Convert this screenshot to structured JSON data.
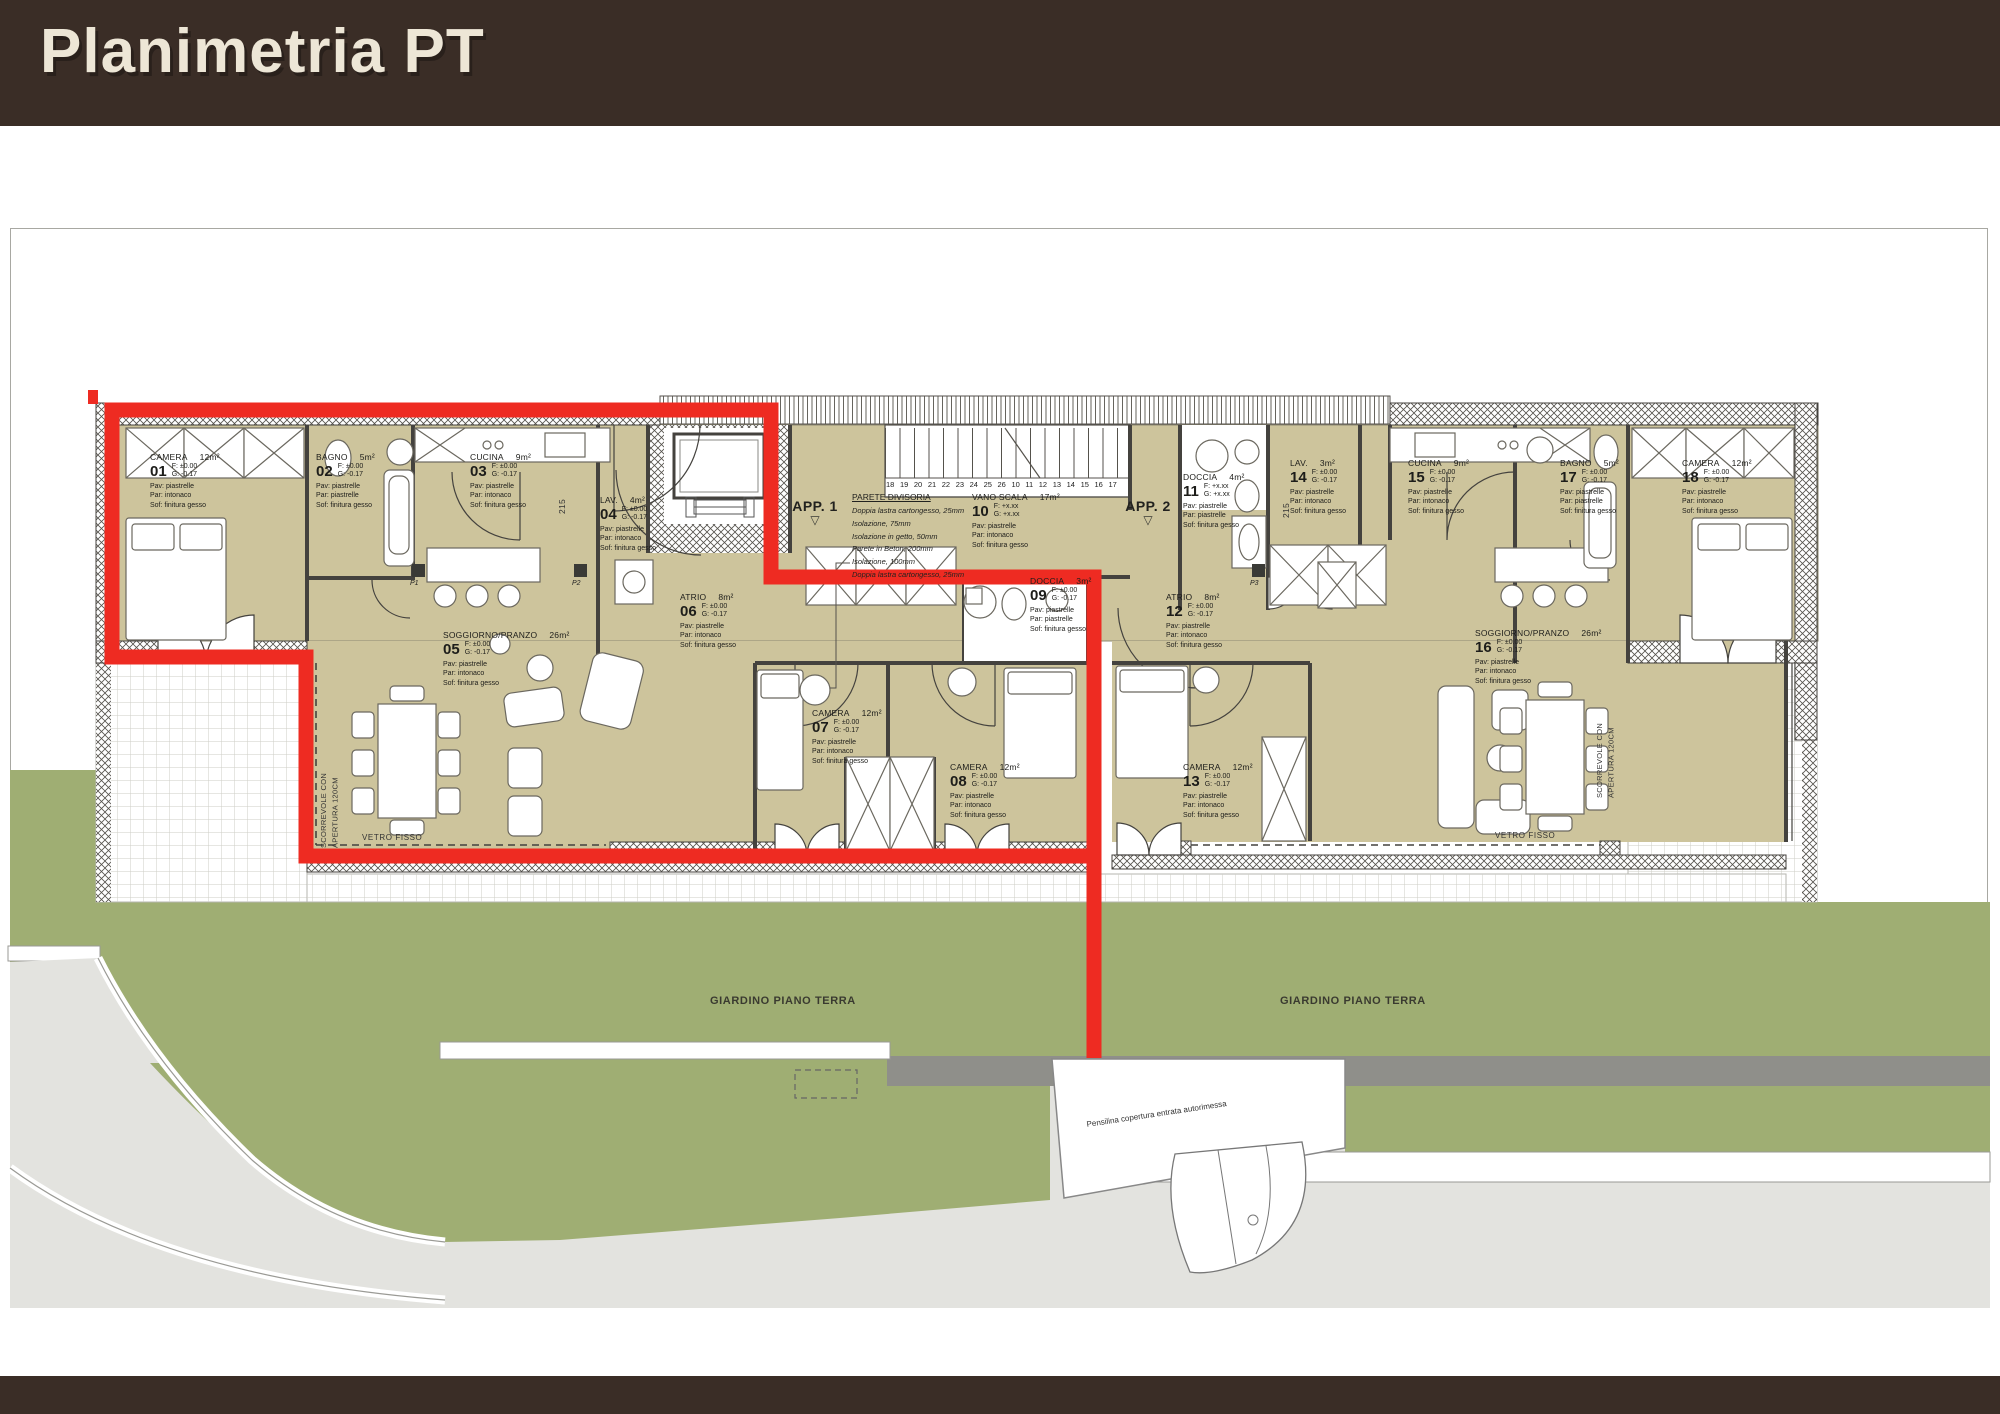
{
  "header": {
    "title": "Planimetria PT"
  },
  "plan": {
    "apartments": [
      {
        "label": "APP. 1"
      },
      {
        "label": "APP. 2"
      }
    ],
    "wall_note": {
      "title": "PARETE DIVISORIA",
      "lines": [
        "Doppia lastra cartongesso, 25mm",
        "Isolazione, 75mm",
        "Isolazione in getto, 50mm",
        "Parete in Beton, 200mm",
        "Isolazione, 100mm",
        "Doppia lastra cartongesso, 25mm"
      ]
    },
    "stair_numbers": [
      "18",
      "19",
      "20",
      "21",
      "22",
      "23",
      "24",
      "25",
      "26",
      "10",
      "11",
      "12",
      "13",
      "14",
      "15",
      "16",
      "17"
    ],
    "annotations": {
      "sliding_door": "SCORREVOLE CON\nAPERTURA 120CM",
      "fixed_glass": "VETRO FISSO",
      "garden": "GIARDINO PIANO TERRA",
      "canopy": "Pensilina copertura entrata autorimessa",
      "stair_width": "215",
      "pillars": [
        "P1",
        "P2",
        "P3"
      ]
    },
    "rooms": [
      {
        "num": "01",
        "name": "CAMERA",
        "area": "12m²",
        "f": "±0.00",
        "g": "-0.17",
        "pav": "piastrelle",
        "par": "intonaco",
        "sof": "finitura gesso",
        "x": 150,
        "y": 452
      },
      {
        "num": "02",
        "name": "BAGNO",
        "area": "5m²",
        "f": "±0.00",
        "g": "-0.17",
        "pav": "piastrelle",
        "par": "piastrelle",
        "sof": "finitura gesso",
        "x": 316,
        "y": 452
      },
      {
        "num": "03",
        "name": "CUCINA",
        "area": "9m²",
        "f": "±0.00",
        "g": "-0.17",
        "pav": "piastrelle",
        "par": "intonaco",
        "sof": "finitura gesso",
        "x": 470,
        "y": 452
      },
      {
        "num": "04",
        "name": "LAV.",
        "area": "4m²",
        "f": "±0.00",
        "g": "-0.17",
        "pav": "piastrelle",
        "par": "intonaco",
        "sof": "finitura gesso",
        "x": 600,
        "y": 495
      },
      {
        "num": "05",
        "name": "SOGGIORNO/PRANZO",
        "area": "26m²",
        "f": "±0.00",
        "g": "-0.17",
        "pav": "piastrelle",
        "par": "intonaco",
        "sof": "finitura gesso",
        "x": 443,
        "y": 630
      },
      {
        "num": "06",
        "name": "ATRIO",
        "area": "8m²",
        "f": "±0.00",
        "g": "-0.17",
        "pav": "piastrelle",
        "par": "intonaco",
        "sof": "finitura gesso",
        "x": 680,
        "y": 592
      },
      {
        "num": "07",
        "name": "CAMERA",
        "area": "12m²",
        "f": "±0.00",
        "g": "-0.17",
        "pav": "piastrelle",
        "par": "intonaco",
        "sof": "finitura gesso",
        "x": 812,
        "y": 708
      },
      {
        "num": "08",
        "name": "CAMERA",
        "area": "12m²",
        "f": "±0.00",
        "g": "-0.17",
        "pav": "piastrelle",
        "par": "intonaco",
        "sof": "finitura gesso",
        "x": 950,
        "y": 762
      },
      {
        "num": "09",
        "name": "DOCCIA",
        "area": "3m²",
        "f": "±0.00",
        "g": "-0.17",
        "pav": "piastrelle",
        "par": "piastrelle",
        "sof": "finitura gesso",
        "x": 1030,
        "y": 576
      },
      {
        "num": "10",
        "name": "VANO SCALA",
        "area": "17m²",
        "f": "+x.xx",
        "g": "+x.xx",
        "pav": "piastrelle",
        "par": "intonaco",
        "sof": "finitura gesso",
        "x": 972,
        "y": 492
      },
      {
        "num": "11",
        "name": "DOCCIA",
        "area": "4m²",
        "f": "+x.xx",
        "g": "+x.xx",
        "pav": "piastrelle",
        "par": "piastrelle",
        "sof": "finitura gesso",
        "x": 1183,
        "y": 472
      },
      {
        "num": "12",
        "name": "ATRIO",
        "area": "8m²",
        "f": "±0.00",
        "g": "-0.17",
        "pav": "piastrelle",
        "par": "intonaco",
        "sof": "finitura gesso",
        "x": 1166,
        "y": 592
      },
      {
        "num": "13",
        "name": "CAMERA",
        "area": "12m²",
        "f": "±0.00",
        "g": "-0.17",
        "pav": "piastrelle",
        "par": "intonaco",
        "sof": "finitura gesso",
        "x": 1183,
        "y": 762
      },
      {
        "num": "14",
        "name": "LAV.",
        "area": "3m²",
        "f": "±0.00",
        "g": "-0.17",
        "pav": "piastrelle",
        "par": "intonaco",
        "sof": "finitura gesso",
        "x": 1290,
        "y": 458
      },
      {
        "num": "15",
        "name": "CUCINA",
        "area": "9m²",
        "f": "±0.00",
        "g": "-0.17",
        "pav": "piastrelle",
        "par": "intonaco",
        "sof": "finitura gesso",
        "x": 1408,
        "y": 458
      },
      {
        "num": "16",
        "name": "SOGGIORNO/PRANZO",
        "area": "26m²",
        "f": "±0.00",
        "g": "-0.17",
        "pav": "piastrelle",
        "par": "intonaco",
        "sof": "finitura gesso",
        "x": 1475,
        "y": 628
      },
      {
        "num": "17",
        "name": "BAGNO",
        "area": "5m²",
        "f": "±0.00",
        "g": "-0.17",
        "pav": "piastrelle",
        "par": "piastrelle",
        "sof": "finitura gesso",
        "x": 1560,
        "y": 458
      },
      {
        "num": "18",
        "name": "CAMERA",
        "area": "12m²",
        "f": "±0.00",
        "g": "-0.17",
        "pav": "piastrelle",
        "par": "intonaco",
        "sof": "finitura gesso",
        "x": 1682,
        "y": 458
      }
    ],
    "colors": {
      "band_brown": "#3a2d26",
      "highlight_red": "#ee2b22",
      "room_tan": "#cdc49c",
      "garden_green": "#9fae73",
      "path_grey": "#8f8f8a",
      "ground_grey": "#e3e3df"
    }
  }
}
